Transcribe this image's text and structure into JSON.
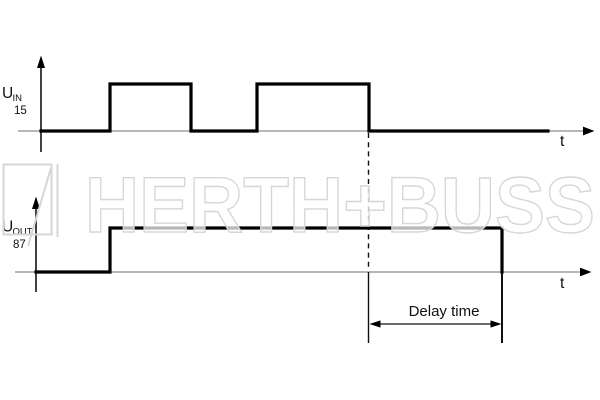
{
  "watermark": {
    "brand": "HERTH+BUSS",
    "logo_icon": "herth-buss-square-flash",
    "color": "#d6d6d6"
  },
  "colors": {
    "signal": "#000000",
    "time_axis": "#8c8c8c",
    "annotation": "#111111",
    "background": "#ffffff"
  },
  "graphs": {
    "input": {
      "quantity": "U",
      "subscript": "IN",
      "terminal": "15",
      "time_label": "t"
    },
    "output": {
      "quantity": "U",
      "subscript": "OUT",
      "terminal": "87",
      "time_label": "t"
    }
  },
  "annotation": {
    "delay_label": "Delay time",
    "dashed_line_px": [
      368.5,
      133,
      368.5,
      271
    ],
    "ext_left_px": [
      368.5,
      272,
      368.5,
      343
    ],
    "ext_right_px": [
      502,
      273,
      502,
      343
    ],
    "dim_line_px": [
      374,
      324,
      497,
      324
    ]
  },
  "chart_data": [
    {
      "type": "line",
      "name": "U_IN (terminal 15) input voltage vs time",
      "waveform": "binary square pulses",
      "low_y_px": 131,
      "high_y_px": 84,
      "segments": [
        {
          "level": "low",
          "from_px": 41,
          "to_px": 110
        },
        {
          "level": "high",
          "from_px": 110,
          "to_px": 191
        },
        {
          "level": "low",
          "from_px": 191,
          "to_px": 257
        },
        {
          "level": "high",
          "from_px": 257,
          "to_px": 369
        },
        {
          "level": "low",
          "from_px": 369,
          "to_px": 548
        }
      ],
      "points_px": [
        [
          41,
          131
        ],
        [
          110,
          131
        ],
        [
          110,
          84
        ],
        [
          191,
          84
        ],
        [
          191,
          131
        ],
        [
          257,
          131
        ],
        [
          257,
          84
        ],
        [
          369,
          84
        ],
        [
          369,
          131
        ],
        [
          548,
          131
        ]
      ]
    },
    {
      "type": "line",
      "name": "U_OUT (terminal 87) output voltage vs time",
      "waveform": "binary step",
      "low_y_px": 272,
      "high_y_px": 228,
      "segments": [
        {
          "level": "low",
          "from_px": 36,
          "to_px": 110
        },
        {
          "level": "high",
          "from_px": 110,
          "to_px": 502
        }
      ],
      "points_px": [
        [
          36,
          272
        ],
        [
          110,
          272
        ],
        [
          110,
          228
        ],
        [
          502,
          228
        ],
        [
          502,
          272
        ]
      ],
      "delay_span_px": {
        "from": 368.5,
        "to": 502
      }
    }
  ]
}
